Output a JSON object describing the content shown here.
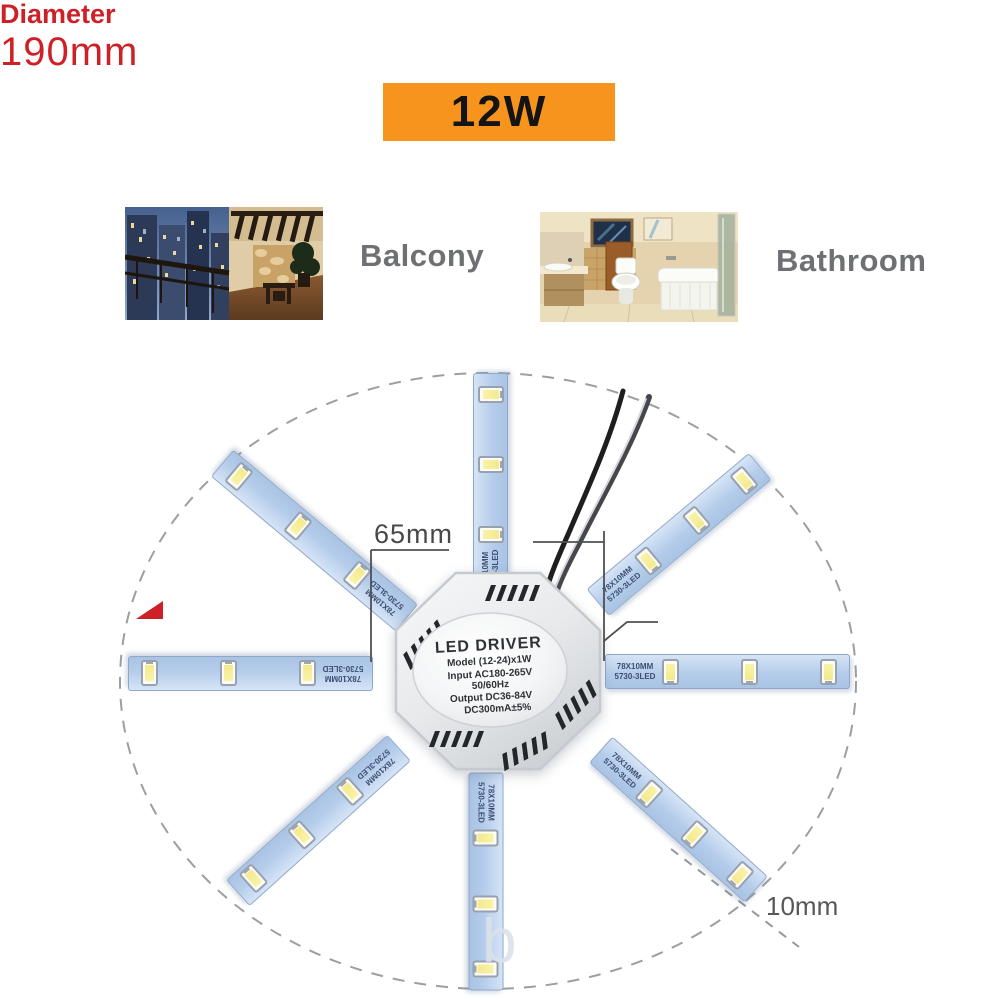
{
  "banner": {
    "wattage": "12W",
    "bg_color": "#F7941E"
  },
  "rooms": [
    {
      "label": "Balcony"
    },
    {
      "label": "Bathroom"
    }
  ],
  "driver": {
    "title": "LED DRIVER",
    "lines": [
      "Model (12-24)x1W",
      "Input AC180-265V",
      "50/60Hz",
      "Output DC36-84V",
      "DC300mA±5%"
    ]
  },
  "strip": {
    "size": "78X10MM",
    "type": "5730-3LED",
    "strip_count": 8,
    "leds_per_strip": 3
  },
  "measurements": {
    "radius": "65mm",
    "diameter_word": "Diameter",
    "diameter_value": "190mm",
    "strip_width": "10mm"
  },
  "watermark": {
    "text": "b"
  },
  "colors": {
    "accent_red": "#CE2127",
    "strip_blue": "#B5CDEB",
    "driver_gray": "#E9EBED"
  }
}
